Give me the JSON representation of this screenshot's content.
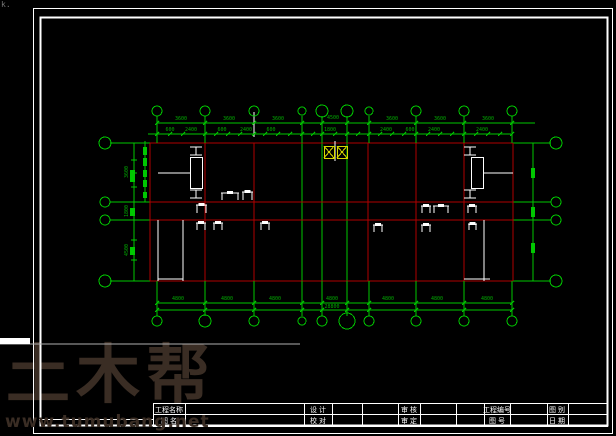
{
  "colors": {
    "green": "#00c800",
    "dim_text": "#00aa00",
    "red": "#b00000",
    "white": "#ffffff",
    "yellow": "#d8d800",
    "watermark": "#3a2d24",
    "gray_line": "#b0b0b0"
  },
  "watermark": {
    "logo": "土木帮",
    "url": "www.tumubang.net"
  },
  "corner_mark": "k.",
  "titleblock": {
    "x1": 153,
    "y1": 403,
    "x2": 607,
    "y2": 426,
    "row_split": 414,
    "left_ext_y": 419,
    "left_ext_x": 39,
    "separators": [
      185,
      304,
      332,
      362,
      398,
      420,
      456,
      484,
      510,
      547,
      568
    ],
    "cells": [
      {
        "cx": 169,
        "row1": "工程名称",
        "row2": "图 名"
      },
      {
        "cx": 318,
        "row1": "设 计",
        "row2": "校 对"
      },
      {
        "cx": 409,
        "row1": "审 核",
        "row2": "审 定"
      },
      {
        "cx": 497,
        "row1": "工程编号",
        "row2": "图 号"
      },
      {
        "cx": 557,
        "row1": "图 别",
        "row2": "日 期"
      }
    ]
  },
  "plan": {
    "axes": {
      "x": [
        157,
        205,
        254,
        302,
        322,
        347,
        369,
        416,
        464,
        512
      ],
      "y_side": [
        143,
        202,
        220,
        281
      ]
    },
    "top_cy": 111,
    "bottom_cy": 321,
    "left_cx": 105,
    "right_cx": 556,
    "top_r": [
      5,
      5,
      5,
      4,
      6,
      6,
      4,
      5,
      5,
      5
    ],
    "bottom_r": [
      5,
      6,
      5,
      4,
      5,
      8,
      5,
      5,
      5,
      5
    ],
    "side_r": [
      6,
      5,
      5,
      6
    ],
    "lines": [
      [
        110,
        143,
        150,
        143,
        "g"
      ],
      [
        110,
        202,
        150,
        202,
        "g"
      ],
      [
        110,
        220,
        150,
        220,
        "g"
      ],
      [
        110,
        281,
        150,
        281,
        "g"
      ],
      [
        513,
        143,
        551,
        143,
        "g"
      ],
      [
        513,
        202,
        551,
        202,
        "g"
      ],
      [
        513,
        220,
        551,
        220,
        "g"
      ],
      [
        513,
        281,
        551,
        281,
        "g"
      ],
      [
        302,
        143,
        302,
        281,
        "g"
      ],
      [
        322,
        143,
        322,
        281,
        "g"
      ],
      [
        347,
        143,
        347,
        281,
        "g"
      ],
      [
        533,
        143,
        533,
        281,
        "g"
      ],
      [
        145,
        141,
        145,
        202,
        "g"
      ],
      [
        134,
        143,
        134,
        281,
        "g"
      ],
      [
        157,
        123,
        535,
        123,
        "g"
      ],
      [
        148,
        134,
        511,
        134,
        "g"
      ],
      [
        157,
        303,
        512,
        303,
        "g"
      ],
      [
        157,
        310,
        512,
        310,
        "g"
      ],
      [
        150,
        143,
        513,
        143,
        "r"
      ],
      [
        150,
        202,
        513,
        202,
        "r"
      ],
      [
        150,
        220,
        513,
        220,
        "r"
      ],
      [
        150,
        281,
        513,
        281,
        "r"
      ],
      [
        150,
        143,
        150,
        281,
        "r"
      ],
      [
        205,
        143,
        205,
        281,
        "r"
      ],
      [
        254,
        143,
        254,
        281,
        "r"
      ],
      [
        368,
        143,
        368,
        281,
        "r"
      ],
      [
        416,
        143,
        416,
        281,
        "r"
      ],
      [
        464,
        143,
        464,
        281,
        "r"
      ],
      [
        513,
        143,
        513,
        281,
        "r"
      ],
      [
        254,
        112,
        254,
        137,
        "w"
      ],
      [
        335,
        141,
        335,
        161,
        "w"
      ],
      [
        158,
        173,
        190,
        173,
        "w"
      ],
      [
        484,
        173,
        513,
        173,
        "w"
      ],
      [
        158,
        220,
        158,
        281,
        "w"
      ],
      [
        183,
        220,
        183,
        281,
        "w"
      ],
      [
        158,
        279,
        183,
        279,
        "w"
      ],
      [
        484,
        220,
        484,
        281,
        "w"
      ],
      [
        464,
        279,
        490,
        279,
        "w"
      ],
      [
        0,
        344,
        300,
        344,
        "gy"
      ]
    ],
    "white_bar": [
      0,
      338,
      30,
      6
    ],
    "ticks2_y": 134,
    "ticks2": [
      170,
      183,
      216,
      228,
      240,
      265,
      278,
      290,
      313,
      335,
      358,
      380,
      392,
      404,
      428,
      440,
      452,
      476,
      488,
      500
    ],
    "left_tick_x": 134,
    "left_ticks": [
      143,
      160,
      173,
      187,
      202,
      220,
      240,
      260,
      281
    ],
    "windows": [
      [
        143,
        147,
        4,
        8
      ],
      [
        143,
        158,
        4,
        8
      ],
      [
        143,
        170,
        4,
        7
      ],
      [
        143,
        180,
        4,
        7
      ],
      [
        143,
        192,
        4,
        6
      ],
      [
        130,
        170,
        5,
        12
      ],
      [
        130,
        208,
        5,
        8
      ],
      [
        130,
        247,
        5,
        8
      ],
      [
        531,
        168,
        4,
        10
      ],
      [
        531,
        207,
        4,
        10
      ],
      [
        531,
        243,
        4,
        10
      ]
    ],
    "stairs": [
      [
        190,
        157,
        12,
        31
      ],
      [
        471,
        157,
        12,
        31
      ]
    ],
    "ibeams": [
      [
        190,
        146,
        12,
        10
      ],
      [
        190,
        189,
        12,
        10
      ],
      [
        464,
        146,
        12,
        10
      ],
      [
        464,
        189,
        12,
        10
      ]
    ],
    "doors": [
      [
        196,
        203,
        11,
        10
      ],
      [
        196,
        221,
        10,
        9
      ],
      [
        213,
        221,
        10,
        9
      ],
      [
        260,
        221,
        10,
        9
      ],
      [
        373,
        223,
        10,
        9
      ],
      [
        421,
        204,
        10,
        9
      ],
      [
        421,
        223,
        10,
        9
      ],
      [
        467,
        204,
        10,
        9
      ],
      [
        468,
        222,
        9,
        8
      ],
      [
        242,
        190,
        11,
        10
      ]
    ],
    "tables": [
      [
        221,
        191,
        18,
        9
      ],
      [
        433,
        204,
        16,
        9
      ]
    ],
    "yellow_boxes": [
      [
        324,
        146,
        10,
        12
      ],
      [
        337,
        146,
        10,
        12
      ]
    ],
    "dim_labels": [
      {
        "x": 181,
        "y": 120,
        "t": "3600"
      },
      {
        "x": 229,
        "y": 120,
        "t": "3600"
      },
      {
        "x": 278,
        "y": 120,
        "t": "3600"
      },
      {
        "x": 333,
        "y": 119,
        "t": "4500"
      },
      {
        "x": 392,
        "y": 120,
        "t": "3600"
      },
      {
        "x": 440,
        "y": 120,
        "t": "3600"
      },
      {
        "x": 488,
        "y": 120,
        "t": "3600"
      },
      {
        "x": 170,
        "y": 131,
        "t": "600"
      },
      {
        "x": 191,
        "y": 131,
        "t": "2400"
      },
      {
        "x": 222,
        "y": 131,
        "t": "600"
      },
      {
        "x": 246,
        "y": 131,
        "t": "2400"
      },
      {
        "x": 271,
        "y": 131,
        "t": "600"
      },
      {
        "x": 330,
        "y": 131,
        "t": "1800"
      },
      {
        "x": 386,
        "y": 131,
        "t": "2400"
      },
      {
        "x": 410,
        "y": 131,
        "t": "600"
      },
      {
        "x": 434,
        "y": 131,
        "t": "2400"
      },
      {
        "x": 482,
        "y": 131,
        "t": "2400"
      },
      {
        "x": 178,
        "y": 300,
        "t": "4800"
      },
      {
        "x": 227,
        "y": 300,
        "t": "4800"
      },
      {
        "x": 275,
        "y": 300,
        "t": "4800"
      },
      {
        "x": 332,
        "y": 300,
        "t": "4800"
      },
      {
        "x": 388,
        "y": 300,
        "t": "4800"
      },
      {
        "x": 437,
        "y": 300,
        "t": "4800"
      },
      {
        "x": 487,
        "y": 300,
        "t": "4800"
      },
      {
        "x": 332,
        "y": 308,
        "t": "28800"
      },
      {
        "x": 128,
        "y": 172,
        "t": "3600",
        "rot": -90
      },
      {
        "x": 128,
        "y": 211,
        "t": "1800",
        "rot": -90
      },
      {
        "x": 128,
        "y": 250,
        "t": "4500",
        "rot": -90
      }
    ],
    "frame": {
      "outer": [
        33,
        8,
        579,
        425
      ],
      "inner": [
        40,
        17,
        567,
        408
      ]
    }
  }
}
